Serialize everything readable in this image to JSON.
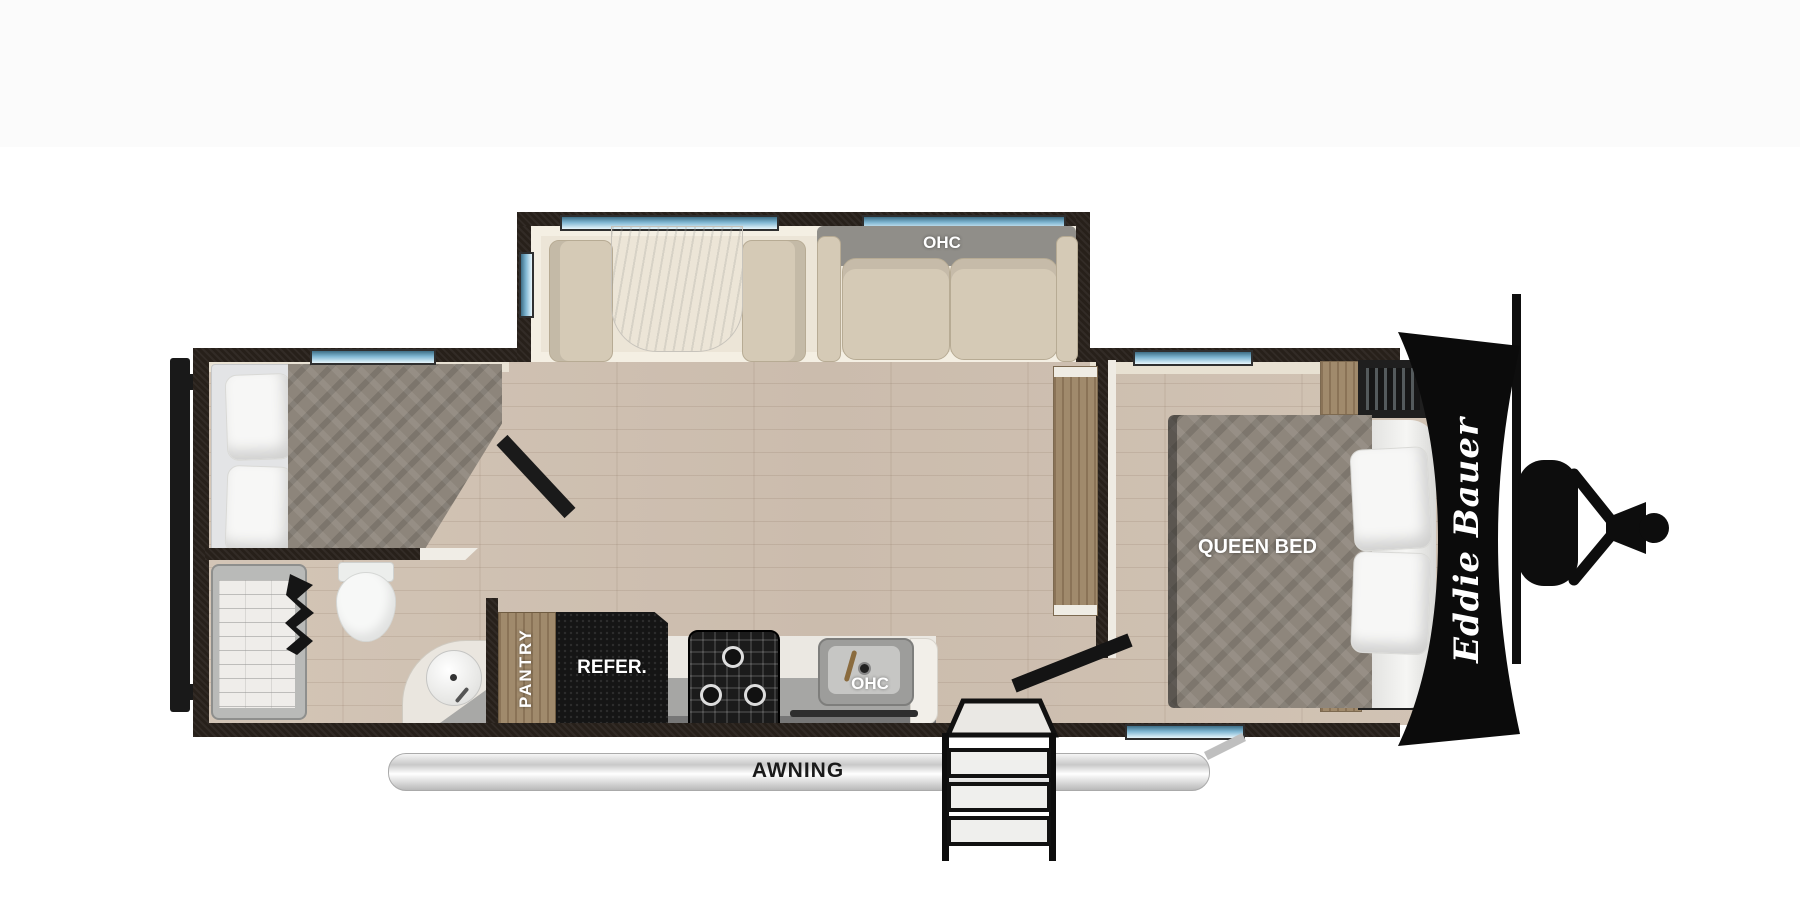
{
  "canvas": {
    "top_band_color": "#fbfbfb",
    "background": "#ffffff"
  },
  "floorplan": {
    "brand": "Eddie Bauer",
    "labels": {
      "slide_ohc": "OHC",
      "kitchen_ohc": "OHC",
      "queen_bed": "QUEEN BED",
      "pantry": "PANTRY",
      "refrigerator": "REFER.",
      "awning": "AWNING"
    },
    "colors": {
      "wall": "#27201a",
      "floor_wood": "#cfc1b2",
      "slide_floor": "#ece5d7",
      "window_blue": "#7fb6d2",
      "mattress_gray": "#8d857b",
      "cabinet_wood": "#a08a6c",
      "appliance_black": "#151515",
      "cushion_cream": "#d5cab6",
      "awning_silver": "#d9d9d9",
      "front_cap": "#0b0b0b",
      "label_text": "#ffffff"
    }
  }
}
